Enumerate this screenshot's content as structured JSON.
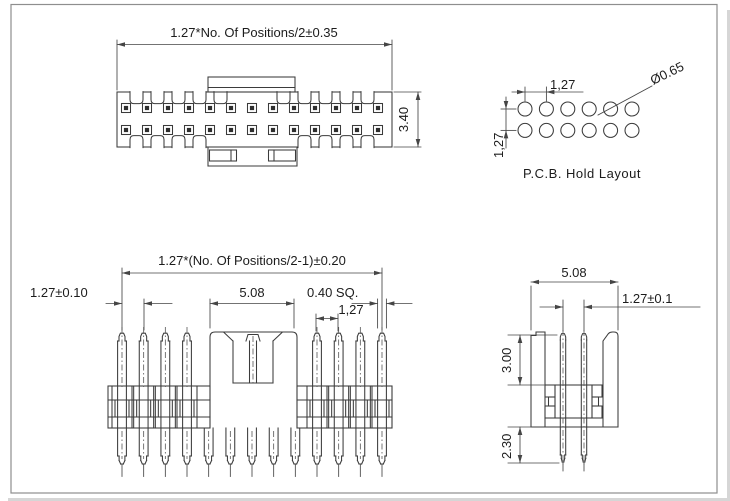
{
  "front_view": {
    "dim_width_label": "1.27*No. Of Positions/2±0.35",
    "dim_height_label": "3.40",
    "pin_columns": 13,
    "pin_rows": 2
  },
  "pcb_layout": {
    "title": "P.C.B. Hold Layout",
    "pitch_h_label": "1,27",
    "pitch_v_label": "1,27",
    "hole_dia_label": "Ø0.65",
    "hole_cols": 6,
    "hole_rows": 2
  },
  "side_view": {
    "span_label": "1.27*(No. Of Positions/2-1)±0.20",
    "pitch_label": "1.27±0.10",
    "shroud_width_label": "5.08",
    "pin_square_label": "0.40 SQ.",
    "row_pitch_label": "1,27",
    "positions": 13,
    "top_pins_visible": 8,
    "bottom_pins": 13
  },
  "end_view": {
    "width_label": "5.08",
    "pitch_label": "1.27±0.1",
    "pin_height_label": "3.00",
    "pin_tail_label": "2.30",
    "pins_per_row": 2
  },
  "colors": {
    "line": "#3b3b3b",
    "dim_line": "#454545",
    "centerline": "#555555",
    "pin_fill": "#2e2e2e",
    "text": "#1c1c1c",
    "frame": "#8e8e8e",
    "background": "#ffffff"
  }
}
